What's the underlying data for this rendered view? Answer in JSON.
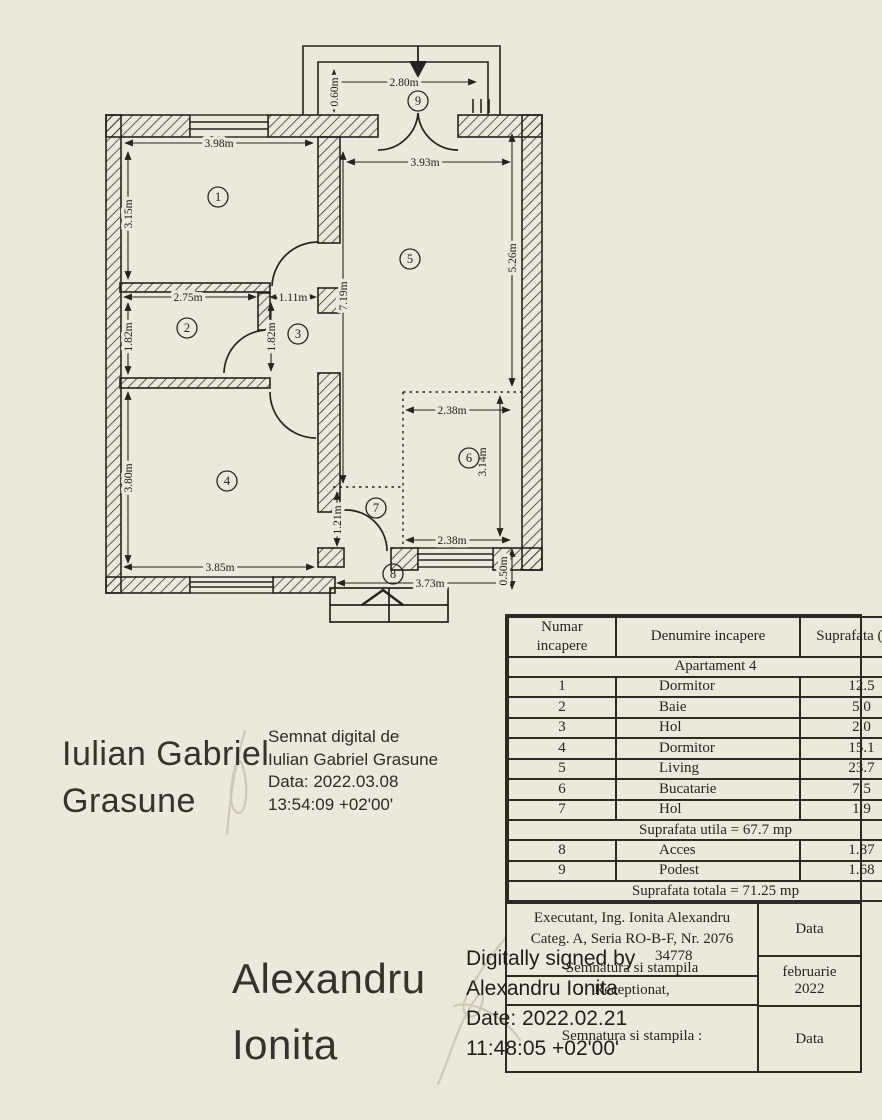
{
  "colors": {
    "paper": "#ece8db",
    "ink": "#24231f",
    "faint_signature": "#c9c3ae"
  },
  "plan": {
    "dims": {
      "d398": "3.98m",
      "d315": "3.15m",
      "d275": "2.75m",
      "d182a": "1.82m",
      "d111": "1.11m",
      "d182b": "1.82m",
      "d380": "3.80m",
      "d385": "3.85m",
      "d719": "7.19m",
      "d393": "3.93m",
      "d526": "5.26m",
      "d238a": "2.38m",
      "d314": "3.14m",
      "d238b": "2.38m",
      "d121": "1.21m",
      "d373": "3.73m",
      "d050": "0.50m",
      "d280": "2.80m",
      "d060": "0.60m"
    },
    "rooms": {
      "n1": "1",
      "n2": "2",
      "n3": "3",
      "n4": "4",
      "n5": "5",
      "n6": "6",
      "n7": "7",
      "n8": "8",
      "n9": "9"
    }
  },
  "table": {
    "headers": {
      "number": "Numar incapere",
      "name": "Denumire incapere",
      "area": "Suprafata (mp)"
    },
    "section": "Apartament 4",
    "rows": [
      {
        "nr": "1",
        "name": "Dormitor",
        "area": "12.5"
      },
      {
        "nr": "2",
        "name": "Baie",
        "area": "5.0"
      },
      {
        "nr": "3",
        "name": "Hol",
        "area": "2.0"
      },
      {
        "nr": "4",
        "name": "Dormitor",
        "area": "15.1"
      },
      {
        "nr": "5",
        "name": "Living",
        "area": "23.7"
      },
      {
        "nr": "6",
        "name": "Bucatarie",
        "area": "7.5"
      },
      {
        "nr": "7",
        "name": "Hol",
        "area": "1.9"
      }
    ],
    "subtotal": "Suprafata utila = 67.7 mp",
    "rows2": [
      {
        "nr": "8",
        "name": "Acces",
        "area": "1.87"
      },
      {
        "nr": "9",
        "name": "Podest",
        "area": "1.68"
      }
    ],
    "total": "Suprafata totala = 71.25 mp",
    "footer": {
      "line1": "Executant, Ing. Ionita Alexandru",
      "line2": "Categ. A, Seria RO-B-F, Nr. 2076",
      "line3_fragment": "34778",
      "line4": "Semnatura si stampila",
      "line5": "Receptionat,",
      "line6": "Semnatura si stampila :",
      "data_top": "Data",
      "period": "februarie 2022",
      "data_bottom": "Data"
    }
  },
  "signatures": {
    "grasune": {
      "name_line1": "Iulian Gabriel",
      "name_line2": "Grasune",
      "stamp_line1": "Semnat digital de",
      "stamp_line2": "Iulian Gabriel Grasune",
      "stamp_line3": "Data: 2022.03.08",
      "stamp_line4": "13:54:09 +02'00'"
    },
    "ionita": {
      "name_line1": "Alexandru",
      "name_line2": "Ionita",
      "stamp_line1": "Digitally signed by",
      "stamp_line2": "Alexandru Ionita",
      "stamp_line3": "Date: 2022.02.21",
      "stamp_line4": "11:48:05 +02'00'"
    }
  }
}
